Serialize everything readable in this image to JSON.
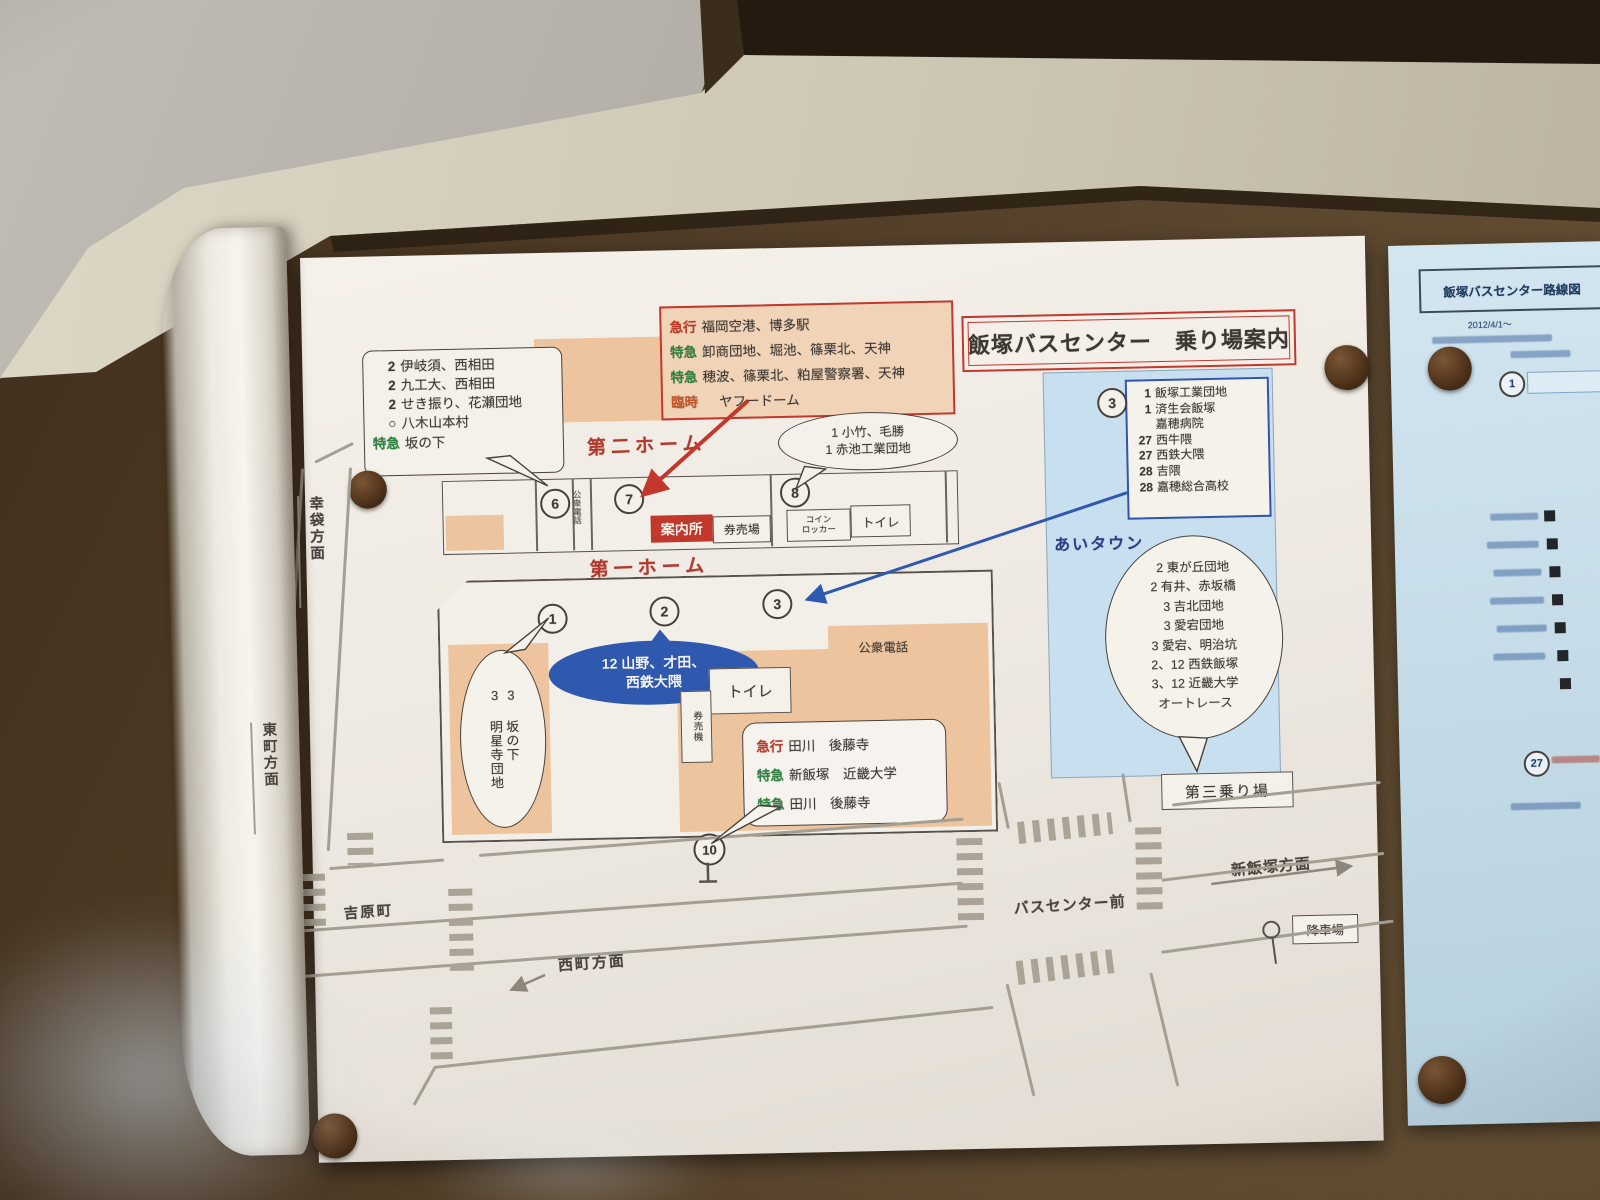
{
  "colors": {
    "accent_red": "#bf3a2b",
    "accent_green": "#2f8140",
    "accent_blue": "#2e59ae",
    "light_blue": "#c7dfee",
    "salmon": "#eec49f",
    "paper": "#f2eee8"
  },
  "poster": {
    "title": "飯塚バスセンター　乗り場案内",
    "express_box": {
      "rows": [
        {
          "label": "急行",
          "text": "福岡空港、博多駅"
        },
        {
          "label": "特急",
          "text": "卸商団地、堀池、篠栗北、天神"
        },
        {
          "label": "特急",
          "text": "穂波、篠栗北、粕屋警察署、天神"
        },
        {
          "label": "臨時",
          "text": "ヤフードーム"
        }
      ]
    },
    "left_bubble": {
      "rows": [
        {
          "no": "2",
          "text": "伊岐須、西相田"
        },
        {
          "no": "2",
          "text": "九工大、西相田"
        },
        {
          "no": "2",
          "text": "せき振り、花瀬団地"
        },
        {
          "no": "○",
          "text": "八木山本村"
        },
        {
          "no": "特急",
          "text": "坂の下"
        }
      ]
    },
    "platform2": {
      "name": "第二ホーム",
      "stop6": "6",
      "stop7": "7",
      "stop8": "8",
      "info": "案内所",
      "ticket": "券売場",
      "locker_l1": "コイン",
      "locker_l2": "ロッカー",
      "toilet": "トイレ",
      "phone": "公衆電話"
    },
    "kotake_bubble": {
      "line1": "1 小竹、毛勝",
      "line2": "1 赤池工業団地"
    },
    "platform1": {
      "name": "第一ホーム",
      "stop1": "1",
      "stop2": "2",
      "stop3": "3",
      "oval_l1": "12 山野、才田、",
      "oval_l2": "西鉄大隈",
      "phone": "公衆電話",
      "toilet": "トイレ",
      "ticket_machine": "券売機",
      "stop10": "10"
    },
    "myojoji_bubble": {
      "col_right": "3 坂の下",
      "col_left": "3 明星寺団地"
    },
    "tagawa_bubble": {
      "rows": [
        {
          "label": "急行",
          "text": "田川　後藤寺"
        },
        {
          "label": "特急",
          "text": "新飯塚　近畿大学"
        },
        {
          "label": "特急",
          "text": "田川　後藤寺"
        }
      ]
    },
    "aitown": {
      "name": "あいタウン",
      "stop3": "3",
      "route_box": {
        "rows": [
          {
            "no": "1",
            "text": "飯塚工業団地"
          },
          {
            "no": "1",
            "text": "済生会飯塚"
          },
          {
            "no": "",
            "text": "嘉穂病院"
          },
          {
            "no": "27",
            "text": "西牛隈"
          },
          {
            "no": "27",
            "text": "西鉄大隈"
          },
          {
            "no": "28",
            "text": "吉隈"
          },
          {
            "no": "28",
            "text": "嘉穂総合高校"
          }
        ]
      },
      "bubble": {
        "lines": [
          "2 東が丘団地",
          "2 有井、赤坂橋",
          "3 吉北団地",
          "3 愛宕団地",
          "3 愛宕、明治坑",
          "2、12 西鉄飯塚",
          "3、12 近畿大学",
          "オートレース"
        ]
      },
      "third_stop": "第三乗り場"
    },
    "streets": {
      "yoshiwara_cho": "吉原町",
      "nishimachi": "西町方面",
      "bus_center_mae": "バスセンター前",
      "shin_iizuka": "新飯塚方面",
      "drop_off": "降車場",
      "kobukuro": "幸袋方面",
      "higashimachi": "東町方面"
    }
  },
  "side_sheet": {
    "title": "飯塚バスセンター路線図",
    "date": "2012/4/1～",
    "stop1": "1",
    "stop27": "27"
  }
}
